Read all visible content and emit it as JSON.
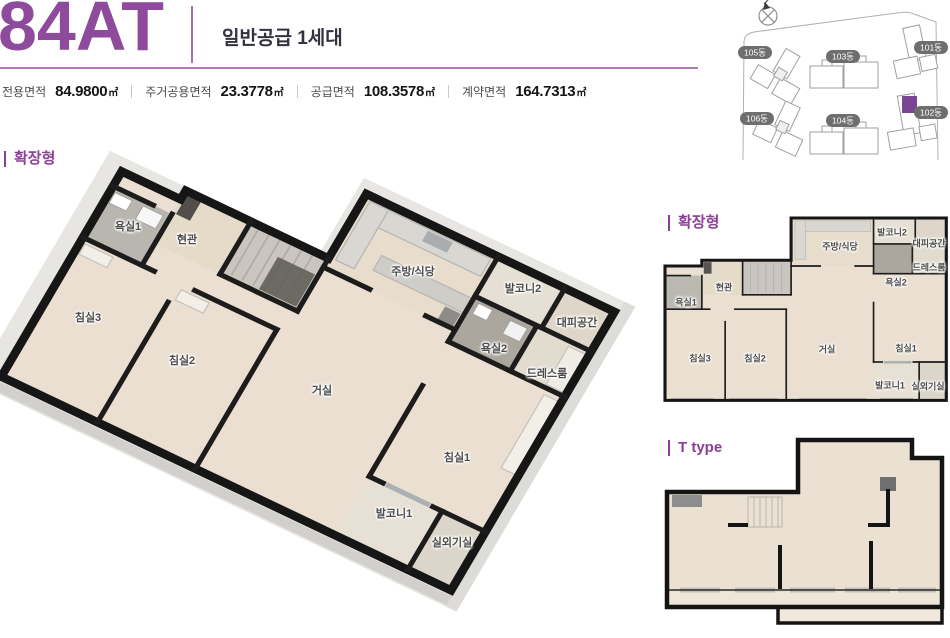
{
  "header": {
    "unit_code": "84AT",
    "supply_info": "일반공급 1세대"
  },
  "area_table": {
    "items": [
      {
        "label": "전용면적",
        "value": "84.9800",
        "unit": "㎡"
      },
      {
        "label": "주거공용면적",
        "value": "23.3778",
        "unit": "㎡"
      },
      {
        "label": "공급면적",
        "value": "108.3578",
        "unit": "㎡"
      },
      {
        "label": "계약면적",
        "value": "164.7313",
        "unit": "㎡"
      }
    ]
  },
  "site_map": {
    "buildings": [
      "105동",
      "103동",
      "101동",
      "106동",
      "104동",
      "102동"
    ],
    "highlighted_building": "102동",
    "highlight_color": "#7b4596",
    "compass": "compass-icon"
  },
  "plans": {
    "main_plan_title": "확장형",
    "mini_plan_title": "확장형",
    "t_type_title": "T type",
    "rooms": [
      "욕실1",
      "현관",
      "주방/식당",
      "발코니2",
      "대피공간",
      "욕실2",
      "드레스룸",
      "침실3",
      "침실2",
      "거실",
      "침실1",
      "발코니1",
      "실외기실"
    ]
  },
  "colors": {
    "brand_purple": "#8e4a9b",
    "line_purple": "#b27ab8",
    "heading_dark": "#32323c",
    "wall_black": "#161616",
    "floor_beige": "#eadfd0"
  }
}
